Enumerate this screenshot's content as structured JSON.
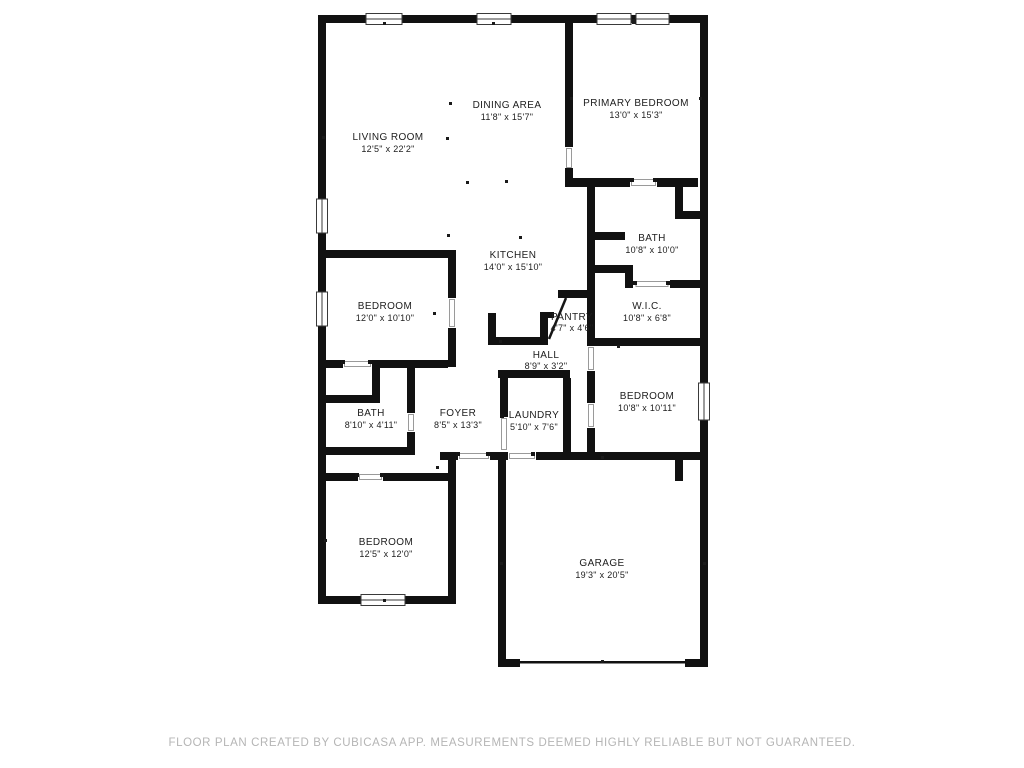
{
  "colors": {
    "background": "#ffffff",
    "wall": "#111111",
    "label_text": "#1d1d1d",
    "footer_text": "#b5b5b5"
  },
  "rooms": [
    {
      "id": "living-room",
      "name": "LIVING ROOM",
      "dims": "12'5\" x 22'2\""
    },
    {
      "id": "dining-area",
      "name": "DINING AREA",
      "dims": "11'8\" x 15'7\""
    },
    {
      "id": "primary-bedroom",
      "name": "PRIMARY BEDROOM",
      "dims": "13'0\" x 15'3\""
    },
    {
      "id": "bath-primary",
      "name": "BATH",
      "dims": "10'8\" x 10'0\""
    },
    {
      "id": "wic",
      "name": "W.I.C.",
      "dims": "10'8\" x 6'8\""
    },
    {
      "id": "kitchen",
      "name": "KITCHEN",
      "dims": "14'0\" x 15'10\""
    },
    {
      "id": "pantry",
      "name": "PANTRY",
      "dims": "4'7\" x 4'6\""
    },
    {
      "id": "hall",
      "name": "HALL",
      "dims": "8'9\" x 3'2\""
    },
    {
      "id": "bedroom-west",
      "name": "BEDROOM",
      "dims": "12'0\" x 10'10\""
    },
    {
      "id": "bath-hall",
      "name": "BATH",
      "dims": "8'10\" x 4'11\""
    },
    {
      "id": "foyer",
      "name": "FOYER",
      "dims": "8'5\" x 13'3\""
    },
    {
      "id": "laundry",
      "name": "LAUNDRY",
      "dims": "5'10\" x 7'6\""
    },
    {
      "id": "bedroom-east",
      "name": "BEDROOM",
      "dims": "10'8\" x 10'11\""
    },
    {
      "id": "bedroom-south",
      "name": "BEDROOM",
      "dims": "12'5\" x 12'0\""
    },
    {
      "id": "garage",
      "name": "GARAGE",
      "dims": "19'3\" x 20'5\""
    }
  ],
  "footer": {
    "disclaimer": "FLOOR PLAN CREATED BY CUBICASA APP. MEASUREMENTS DEEMED HIGHLY RELIABLE BUT NOT GUARANTEED."
  }
}
